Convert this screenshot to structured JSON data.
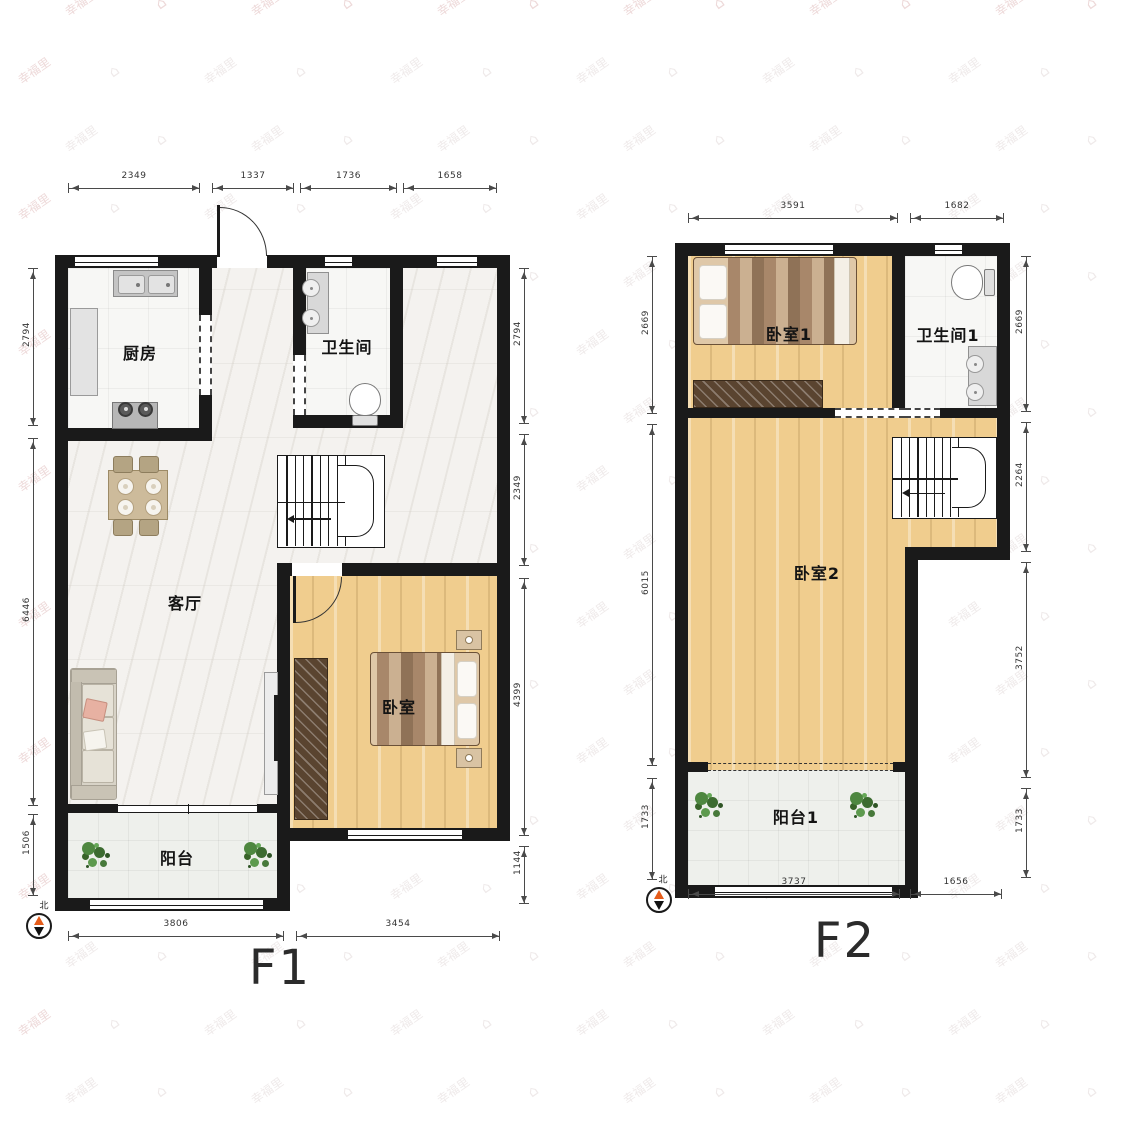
{
  "watermark": {
    "text": "幸福里"
  },
  "floors": [
    {
      "label": "F1",
      "compass_label": "北",
      "rooms": [
        {
          "name": "厨房"
        },
        {
          "name": "卫生间"
        },
        {
          "name": "客厅"
        },
        {
          "name": "卧室"
        },
        {
          "name": "阳台"
        }
      ],
      "dimensions": {
        "top": [
          "2349",
          "1337",
          "1736",
          "1658"
        ],
        "left": [
          "2794",
          "6446",
          "1506"
        ],
        "right": [
          "2794",
          "2349",
          "4399",
          "1144"
        ],
        "bottom": [
          "3806",
          "3454"
        ]
      }
    },
    {
      "label": "F2",
      "compass_label": "北",
      "rooms": [
        {
          "name": "卧室1"
        },
        {
          "name": "卫生间1"
        },
        {
          "name": "卧室2"
        },
        {
          "name": "阳台1"
        }
      ],
      "dimensions": {
        "top": [
          "3591",
          "1682"
        ],
        "left": [
          "2669",
          "6015",
          "1733"
        ],
        "right": [
          "2669",
          "2264",
          "3752",
          "1733"
        ],
        "bottom": [
          "3737",
          "1656"
        ]
      }
    }
  ]
}
